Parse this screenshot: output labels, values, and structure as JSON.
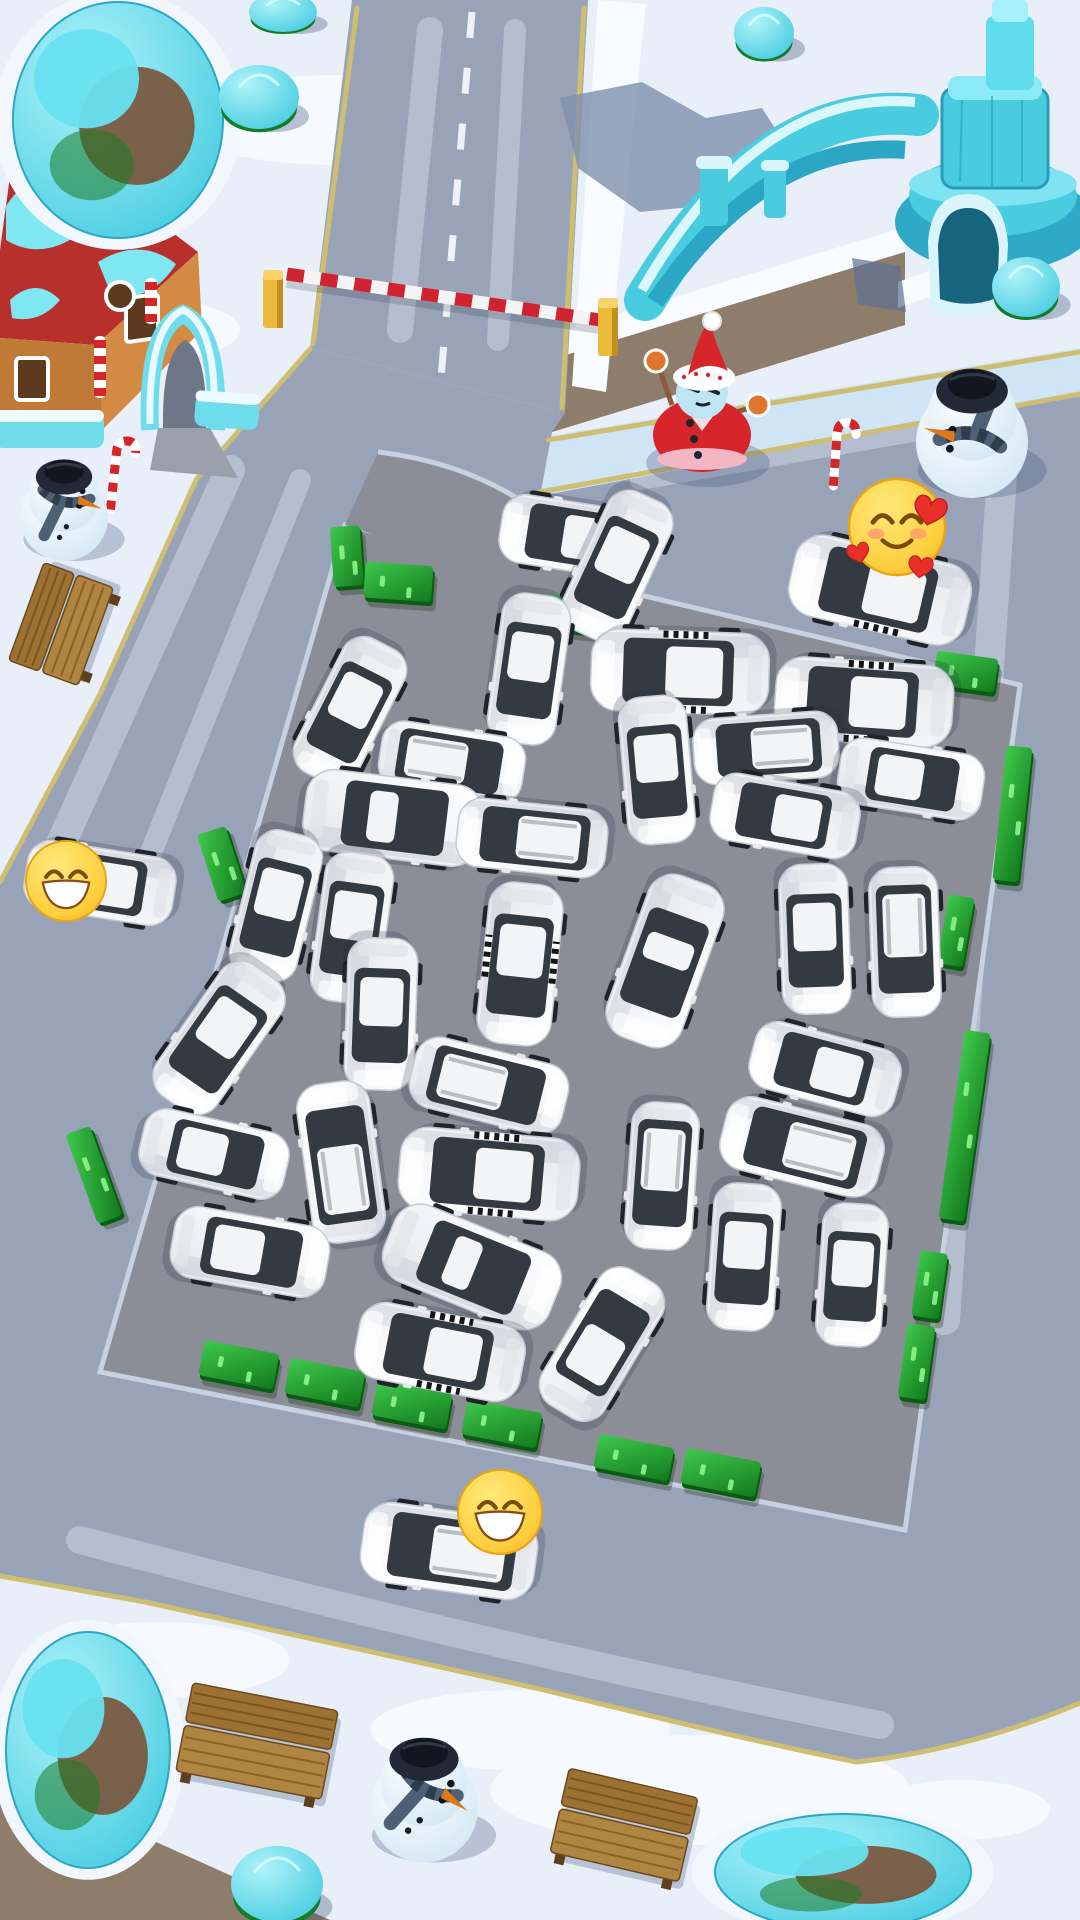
{
  "scene": {
    "description": "Winter-themed car parking jam puzzle board viewed from above",
    "visible_text": "",
    "board": {
      "lot_corners": [
        [
          345,
          525
        ],
        [
          1020,
          685
        ],
        [
          905,
          1530
        ],
        [
          100,
          1372
        ]
      ]
    }
  },
  "colors": {
    "snow": "#e9eff8",
    "snow_patch": "#f7fafe",
    "ice_walk": "#cfe4f4",
    "dirt": "#8d7d6a",
    "road": "#99a3b7",
    "road_worn": "#c9d2e2",
    "lot": "#8b8e96",
    "curb": "#c6d1e1",
    "lane_yellow": "#cdbe72",
    "lane_dash": "#eef1f7",
    "hedge_dark": "#0a5c12",
    "hedge_light": "#2fb13c",
    "hedge_glow": "#8df58b",
    "car_white": "#f7f8fa",
    "car_glass": "#343a41",
    "car_roof": "#f3f4f6",
    "taxi_check": "#14161a",
    "wood": "#a87c3e",
    "wood_dark": "#7a5522",
    "ice_object": "#49cbe0",
    "ice_deep": "#2ba6c4",
    "ice_hi": "#aef3f9",
    "rock_brown": "#7a4a2e",
    "tree_green": "#157d2a",
    "snowman_hat": "#232936",
    "scarf": "#4e6076",
    "carrot": "#e07818",
    "santa_red": "#d6252b",
    "santa_trim": "#f2b7c3",
    "santa_skin": "#bfe4f2",
    "mitten": "#e0762c",
    "barrier_red": "#cf2330",
    "barrier_white": "#f4f4f4",
    "post_yellow": "#ecba3a",
    "post_shade": "#c08f1f",
    "emoji_face_hi": "#ffe878",
    "emoji_face": "#f9bf2c",
    "emoji_rim": "#e9a416",
    "emoji_line": "#7a4b0c",
    "heart_red": "#ea2f2a"
  },
  "emojis": [
    {
      "name": "grinning-face-emoji",
      "glyph": "😄",
      "type": "grin",
      "x": 66,
      "y": 881,
      "size": 80
    },
    {
      "name": "smiling-face-with-hearts-emoji",
      "glyph": "🥰",
      "type": "love",
      "x": 897,
      "y": 527,
      "size": 96
    },
    {
      "name": "beaming-face-emoji",
      "glyph": "😁",
      "type": "grin",
      "x": 500,
      "y": 1512,
      "size": 84
    }
  ],
  "cars": [
    {
      "x": 575,
      "y": 537,
      "rot": 279,
      "len": 150,
      "type": "hatch",
      "surface": "road"
    },
    {
      "x": 880,
      "y": 590,
      "rot": 283,
      "len": 180,
      "type": "taxi",
      "surface": "road"
    },
    {
      "x": 449,
      "y": 1551,
      "rot": 278,
      "len": 175,
      "type": "suv",
      "surface": "road"
    },
    {
      "x": 100,
      "y": 883,
      "rot": 279,
      "len": 150,
      "type": "sedan",
      "surface": "road"
    },
    {
      "x": 617,
      "y": 566,
      "rot": 205,
      "len": 152,
      "type": "sedan",
      "surface": "lot"
    },
    {
      "x": 350,
      "y": 711,
      "rot": 207,
      "len": 150,
      "type": "hatch",
      "surface": "lot"
    },
    {
      "x": 529,
      "y": 669,
      "rot": 188,
      "len": 150,
      "type": "sedan",
      "surface": "lot"
    },
    {
      "x": 452,
      "y": 762,
      "rot": 99,
      "len": 145,
      "type": "suv",
      "surface": "lot"
    },
    {
      "x": 393,
      "y": 818,
      "rot": 97,
      "len": 178,
      "type": "coupe",
      "surface": "lot"
    },
    {
      "x": 532,
      "y": 838,
      "rot": 276,
      "len": 150,
      "type": "suv",
      "surface": "lot"
    },
    {
      "x": 680,
      "y": 672,
      "rot": 272,
      "len": 178,
      "type": "taxi",
      "surface": "lot"
    },
    {
      "x": 864,
      "y": 702,
      "rot": 274,
      "len": 178,
      "type": "taxi",
      "surface": "lot"
    },
    {
      "x": 766,
      "y": 748,
      "rot": 266,
      "len": 145,
      "type": "suv",
      "surface": "lot"
    },
    {
      "x": 911,
      "y": 779,
      "rot": 99,
      "len": 145,
      "type": "sedan",
      "surface": "lot"
    },
    {
      "x": 785,
      "y": 816,
      "rot": 280,
      "len": 148,
      "type": "hatch",
      "surface": "lot"
    },
    {
      "x": 657,
      "y": 770,
      "rot": 175,
      "len": 148,
      "type": "sedan",
      "surface": "lot"
    },
    {
      "x": 276,
      "y": 906,
      "rot": 194,
      "len": 150,
      "type": "sedan",
      "surface": "lot"
    },
    {
      "x": 352,
      "y": 928,
      "rot": 188,
      "len": 150,
      "type": "hatch",
      "surface": "lot"
    },
    {
      "x": 219,
      "y": 1038,
      "rot": 215,
      "len": 160,
      "type": "sedan",
      "surface": "lot"
    },
    {
      "x": 381,
      "y": 1014,
      "rot": 182,
      "len": 152,
      "type": "sedan",
      "surface": "lot"
    },
    {
      "x": 520,
      "y": 964,
      "rot": 186,
      "len": 162,
      "type": "taxi",
      "surface": "lot"
    },
    {
      "x": 665,
      "y": 961,
      "rot": 200,
      "len": 172,
      "type": "coupe",
      "surface": "lot"
    },
    {
      "x": 815,
      "y": 939,
      "rot": 178,
      "len": 150,
      "type": "sedan",
      "surface": "lot"
    },
    {
      "x": 905,
      "y": 942,
      "rot": 178,
      "len": 150,
      "type": "suv",
      "surface": "lot"
    },
    {
      "x": 489,
      "y": 1086,
      "rot": 104,
      "len": 157,
      "type": "suv",
      "surface": "lot"
    },
    {
      "x": 341,
      "y": 1162,
      "rot": 352,
      "len": 160,
      "type": "suv",
      "surface": "lot"
    },
    {
      "x": 214,
      "y": 1154,
      "rot": 103,
      "len": 148,
      "type": "hatch",
      "surface": "lot"
    },
    {
      "x": 489,
      "y": 1174,
      "rot": 275,
      "len": 180,
      "type": "taxi",
      "surface": "lot"
    },
    {
      "x": 825,
      "y": 1069,
      "rot": 285,
      "len": 150,
      "type": "hatch",
      "surface": "lot"
    },
    {
      "x": 802,
      "y": 1147,
      "rot": 284,
      "len": 162,
      "type": "suv",
      "surface": "lot"
    },
    {
      "x": 250,
      "y": 1252,
      "rot": 100,
      "len": 157,
      "type": "hatch",
      "surface": "lot"
    },
    {
      "x": 472,
      "y": 1267,
      "rot": 112,
      "len": 178,
      "type": "coupe",
      "surface": "lot"
    },
    {
      "x": 662,
      "y": 1176,
      "rot": 184,
      "len": 147,
      "type": "suv",
      "surface": "lot"
    },
    {
      "x": 744,
      "y": 1257,
      "rot": 184,
      "len": 147,
      "type": "hatch",
      "surface": "lot"
    },
    {
      "x": 852,
      "y": 1275,
      "rot": 184,
      "len": 143,
      "type": "hatch",
      "surface": "lot"
    },
    {
      "x": 440,
      "y": 1352,
      "rot": 281,
      "len": 168,
      "type": "taxi",
      "surface": "lot"
    },
    {
      "x": 602,
      "y": 1344,
      "rot": 31,
      "len": 158,
      "type": "sedan",
      "surface": "lot"
    }
  ],
  "hedges": [
    {
      "x": 349,
      "y": 560,
      "w": 30,
      "h": 60,
      "rot": -4
    },
    {
      "x": 400,
      "y": 586,
      "w": 68,
      "h": 36,
      "rot": 4
    },
    {
      "x": 577,
      "y": 618,
      "w": 58,
      "h": 34,
      "rot": 6
    },
    {
      "x": 967,
      "y": 676,
      "w": 62,
      "h": 34,
      "rot": 8
    },
    {
      "x": 1014,
      "y": 818,
      "w": 26,
      "h": 135,
      "rot": 6
    },
    {
      "x": 957,
      "y": 935,
      "w": 26,
      "h": 70,
      "rot": 10
    },
    {
      "x": 966,
      "y": 1130,
      "w": 26,
      "h": 190,
      "rot": 8
    },
    {
      "x": 931,
      "y": 1289,
      "w": 28,
      "h": 66,
      "rot": 8
    },
    {
      "x": 918,
      "y": 1366,
      "w": 28,
      "h": 74,
      "rot": 8
    },
    {
      "x": 225,
      "y": 867,
      "w": 30,
      "h": 70,
      "rot": -18
    },
    {
      "x": 97,
      "y": 1178,
      "w": 26,
      "h": 95,
      "rot": -20
    },
    {
      "x": 240,
      "y": 1369,
      "w": 76,
      "h": 36,
      "rot": 11
    },
    {
      "x": 326,
      "y": 1387,
      "w": 76,
      "h": 36,
      "rot": 11
    },
    {
      "x": 413,
      "y": 1409,
      "w": 76,
      "h": 36,
      "rot": 11
    },
    {
      "x": 503,
      "y": 1428,
      "w": 76,
      "h": 36,
      "rot": 11
    },
    {
      "x": 635,
      "y": 1462,
      "w": 76,
      "h": 34,
      "rot": 11
    },
    {
      "x": 722,
      "y": 1477,
      "w": 76,
      "h": 36,
      "rot": 11
    }
  ],
  "benches": [
    {
      "x": 61,
      "y": 624,
      "len": 104,
      "dep": 74,
      "rot": -70
    },
    {
      "x": 257,
      "y": 1741,
      "len": 148,
      "dep": 90,
      "rot": 11
    },
    {
      "x": 624,
      "y": 1825,
      "len": 132,
      "dep": 86,
      "rot": 13
    }
  ],
  "snowmen": [
    {
      "variant": "classic",
      "x": 64,
      "y": 506,
      "r": 44,
      "face": 12
    },
    {
      "variant": "classic",
      "x": 972,
      "y": 428,
      "r": 56,
      "face": 188
    },
    {
      "variant": "classic",
      "x": 424,
      "y": 1795,
      "r": 54,
      "face": 28
    },
    {
      "variant": "santa",
      "x": 702,
      "y": 405,
      "r": 50
    }
  ],
  "candy_canes": [
    {
      "x": 118,
      "y": 438,
      "h": 72,
      "rot": 6
    },
    {
      "x": 838,
      "y": 420,
      "h": 66,
      "rot": 4
    }
  ],
  "trees": [
    {
      "x": 259,
      "y": 97,
      "rx": 40,
      "ry": 32
    },
    {
      "x": 283,
      "y": 12,
      "rx": 34,
      "ry": 20
    },
    {
      "x": 764,
      "y": 33,
      "rx": 30,
      "ry": 26
    },
    {
      "x": 1026,
      "y": 287,
      "rx": 34,
      "ry": 30
    },
    {
      "x": 277,
      "y": 1884,
      "rx": 46,
      "ry": 38
    }
  ],
  "ice_rocks": [
    {
      "x": 118,
      "y": 120,
      "rx": 105,
      "ry": 118
    },
    {
      "x": 88,
      "y": 1750,
      "rx": 82,
      "ry": 118
    },
    {
      "x": 843,
      "y": 1872,
      "rx": 128,
      "ry": 58
    }
  ],
  "barrier": {
    "arm": {
      "x1": 287,
      "y1": 274,
      "x2": 600,
      "y2": 320
    },
    "posts": [
      {
        "x": 273,
        "y": 300
      },
      {
        "x": 608,
        "y": 328
      }
    ]
  },
  "house": {
    "x": 0,
    "y": 148,
    "label": "gingerbread-house"
  },
  "fountain": {
    "x": 560,
    "y": 0,
    "label": "ice-castle-fountain"
  }
}
